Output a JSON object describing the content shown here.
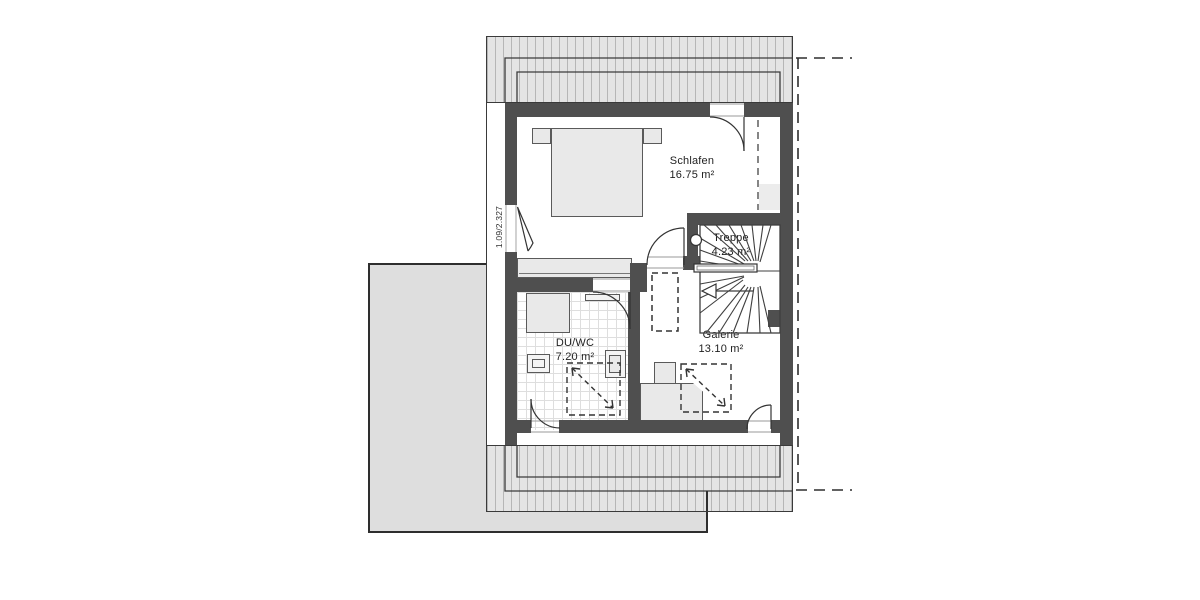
{
  "theme": {
    "wall": "#4f4f4f",
    "line": "#3a3a3a",
    "roof_fill": "#e4e4e4",
    "roof_line": "#b6b6b6",
    "furniture_fill": "#e9e9e9",
    "furniture_line": "#5a5a5a",
    "lower_fill": "#dedede",
    "tile_line": "#dedede",
    "patch": "#ececec",
    "text": "#1f1f1f",
    "bg": "#ffffff"
  },
  "plan": {
    "rooms": {
      "schlafen": {
        "label": "Schlafen",
        "area": "16.75 m²"
      },
      "treppe": {
        "label": "Treppe",
        "area": "4.23 m²"
      },
      "duwc": {
        "label": "DU/WC",
        "area": "7.20 m²"
      },
      "galerie": {
        "label": "Galerie",
        "area": "13.10 m²"
      }
    },
    "annotations": {
      "left_door_size": "1.09/2.327"
    }
  }
}
